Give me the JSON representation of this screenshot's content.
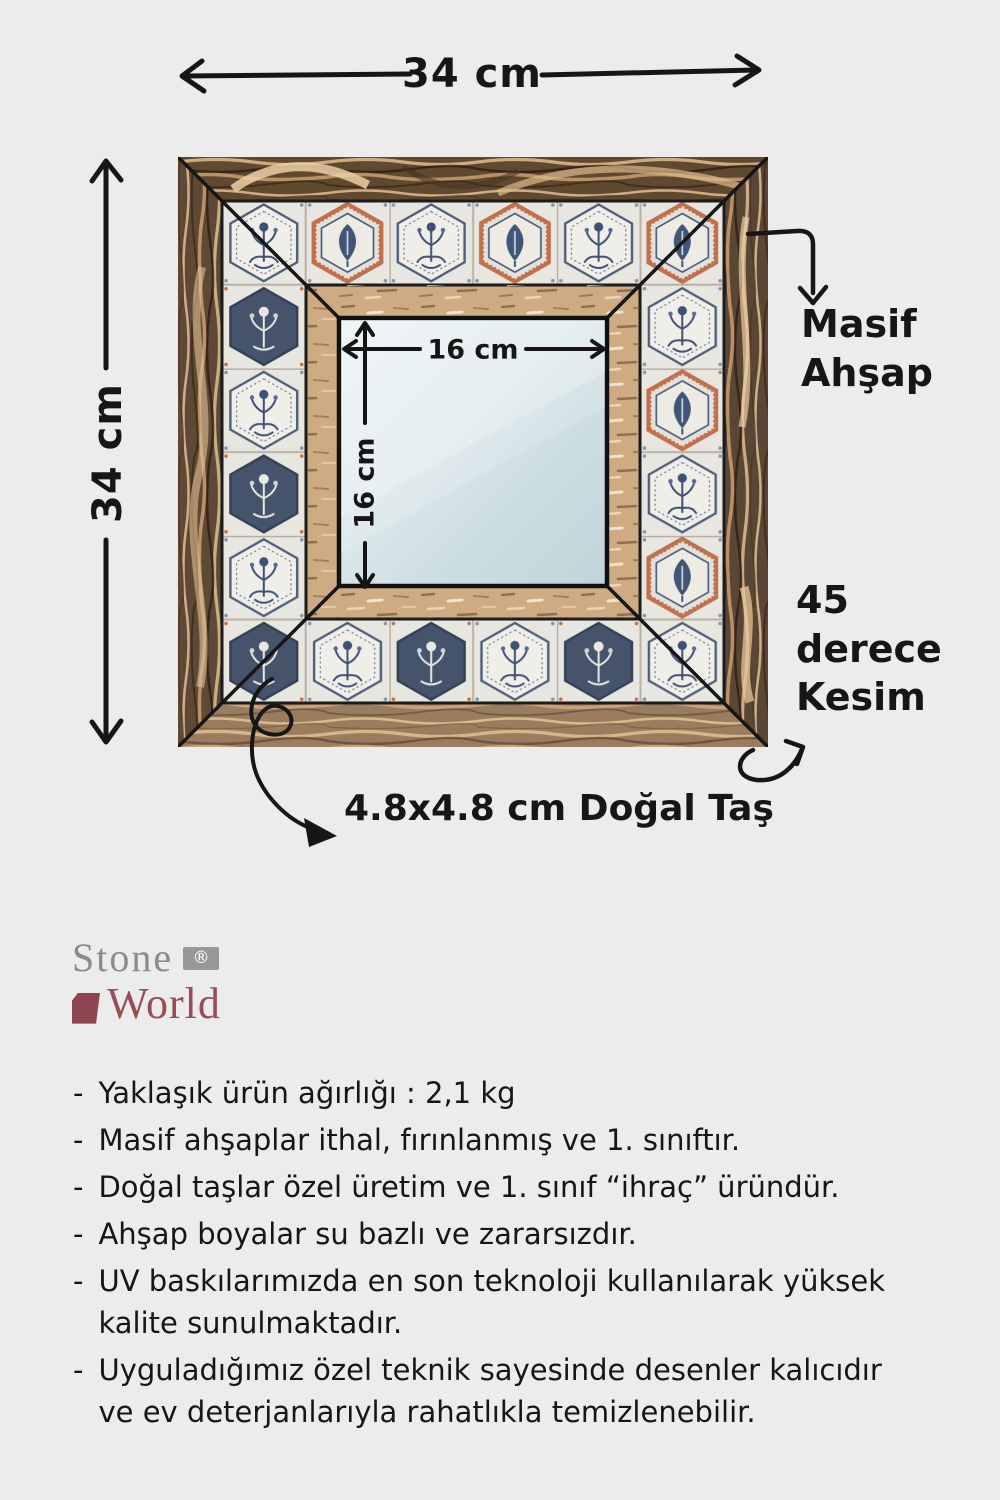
{
  "canvas": {
    "background": "#ebeceb"
  },
  "diagram": {
    "outer_width_label": "34 cm",
    "outer_height_label": "34 cm",
    "mirror_width_label": "16 cm",
    "mirror_height_label": "16 cm",
    "wood_callout": "Masif\nAhşap",
    "miter_callout": "45\nderece\nKesim",
    "stone_callout": "4.8x4.8 cm Doğal Taş"
  },
  "logo": {
    "line1": "Stone",
    "reg": "®",
    "line2": "World"
  },
  "features": {
    "bullet": "-",
    "items": [
      "Yaklaşık ürün ağırlığı : 2,1 kg",
      "Masif ahşaplar ithal, fırınlanmış ve 1. sınıftır.",
      "Doğal taşlar özel üretim ve 1. sınıf “ihraç” üründür.",
      "Ahşap boyalar su bazlı ve zararsızdır.",
      "UV baskılarımızda en son teknoloji kullanılarak yüksek\nkalite sunulmaktadır.",
      "Uyguladığımız özel teknik sayesinde desenler kalıcıdır\nve ev deterjanlarıyla rahatlıkla temizlenebilir."
    ]
  },
  "colors": {
    "accent_navy": "#3e5173",
    "accent_terracotta": "#c0714c",
    "wood_dark": "#64503b",
    "wood_light": "#c9a67e",
    "mirror_blue": "#d9e6ea",
    "logo_gray": "#8b8b8f",
    "logo_maroon": "#9a4c55"
  }
}
